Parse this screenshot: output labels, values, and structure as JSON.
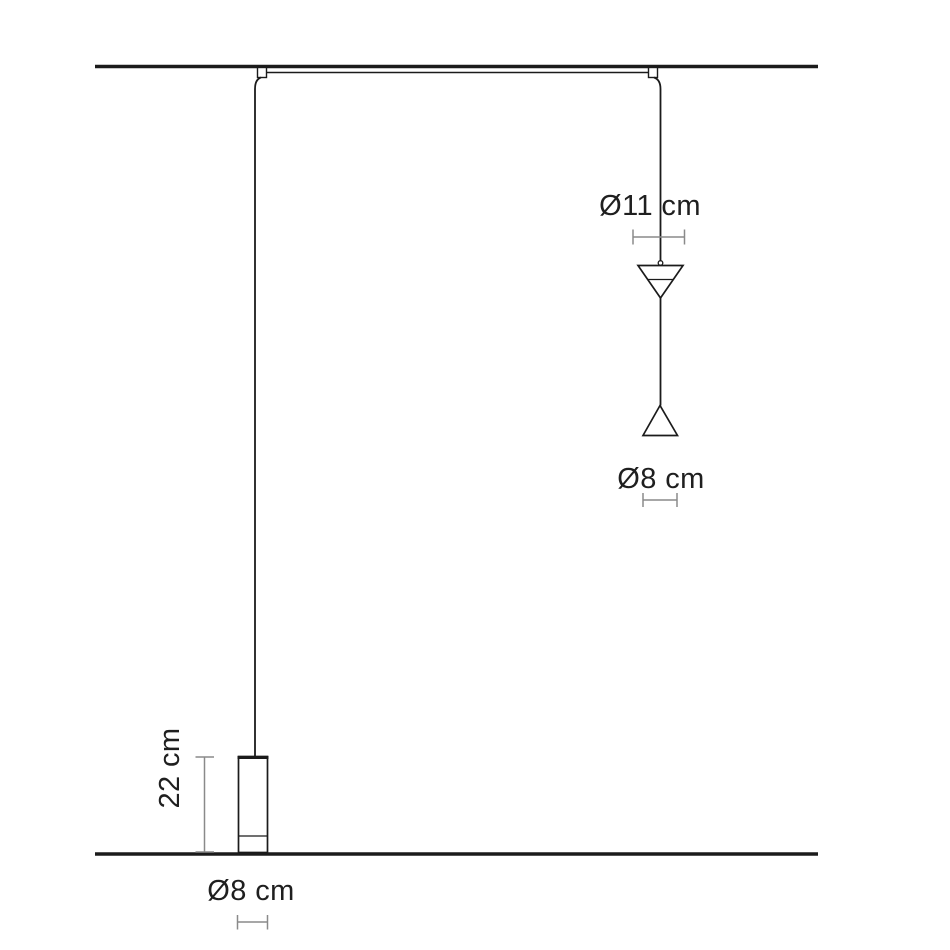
{
  "diagram": {
    "kind": "pendant-lamp-dimension-drawing",
    "labels": {
      "cone_diameter": "Ø11 cm",
      "cone_tip_diameter": "Ø8 cm",
      "cylinder_height": "22 cm",
      "cylinder_diameter": "Ø8 cm"
    },
    "colors": {
      "background": "#ffffff",
      "line": "#1b1b1b",
      "dimension_line": "#8a8a8a",
      "text": "#1f1f1f"
    }
  }
}
